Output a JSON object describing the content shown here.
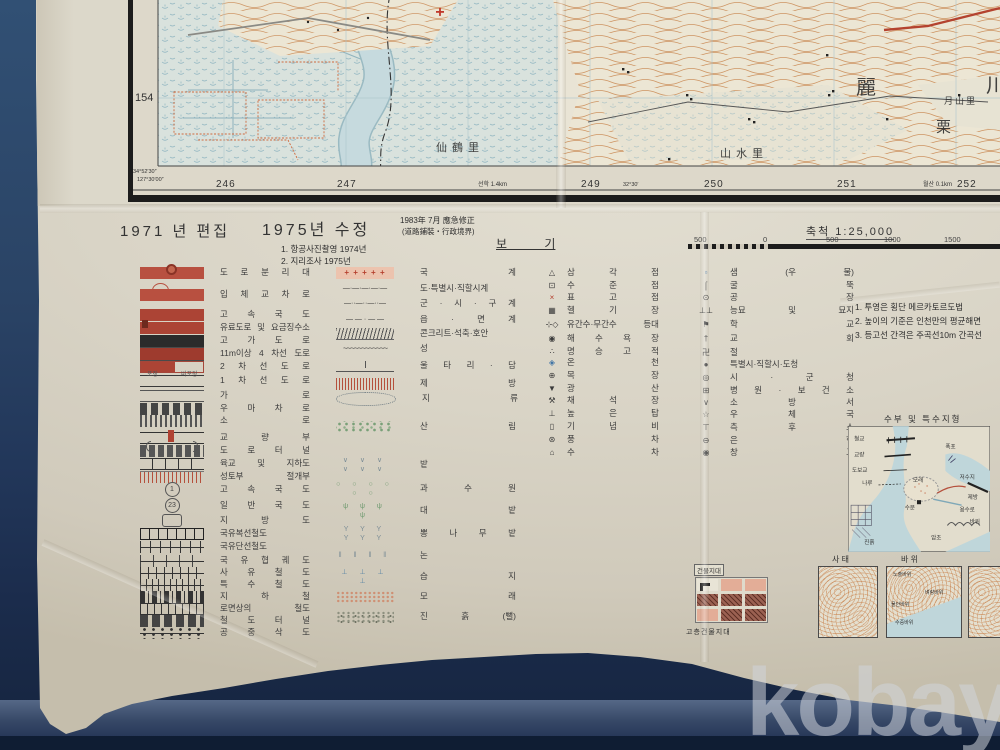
{
  "photo": {
    "watermark": "kobay"
  },
  "map": {
    "row_label": "154",
    "corner_lat": "34°52′30″",
    "corner_lon": "127°30′00″",
    "grid_numb ers_note": "easting grid labels",
    "grid_numbers": [
      "246",
      "247",
      "249",
      "250",
      "251",
      "252"
    ],
    "lon_tick": "32°30′",
    "note_left": "선학 1.4km",
    "note_right": "월산 0.1km",
    "names": {
      "n1": "仙鶴里",
      "n2": "山水里",
      "n3": "月山里",
      "c1": "麗",
      "c2": "栗",
      "c3": "川"
    }
  },
  "header": {
    "edition": "1971 년 편집",
    "revision": "1975년 수정",
    "emergency1": "1983年 7月 應急修正",
    "emergency2": "(道路鋪裝・行政境界)",
    "survey1": "1. 항공사진촬영  1974년",
    "survey2": "2. 지리조사  1975년",
    "legend_title": "보 기",
    "scale_label": "축척 1:25,000",
    "scale_ticks": [
      "500",
      "0",
      "500",
      "1000",
      "1500"
    ]
  },
  "legend": {
    "road_sub": {
      "paved": "포장",
      "unpaved": "비포장"
    },
    "roads": [
      {
        "c": "s-median",
        "g": "",
        "label": "도 로 분 리 대"
      },
      {
        "c": "s-interchange",
        "g": "",
        "label": "입 체 교 차 로"
      },
      {
        "c": "s-expwy",
        "g": "",
        "label": "고 속 국 도"
      },
      {
        "c": "s-toll",
        "g": "",
        "label": "유료도로 및 요금징수소"
      },
      {
        "c": "s-elevated",
        "g": "",
        "label": "고 가 도 로"
      },
      {
        "c": "s-lane4",
        "g": "",
        "label": "11m이상 4 차선 도로"
      },
      {
        "c": "s-lane2",
        "g": "",
        "label": "2 차 선 도 로"
      },
      {
        "c": "s-lane1",
        "g": "",
        "label": "1 차 선 도 로"
      },
      {
        "c": "s-street",
        "g": "",
        "label": "가 로"
      },
      {
        "c": "s-cart",
        "g": "",
        "label": "우 마 차 로"
      },
      {
        "c": "s-path",
        "g": "",
        "label": "소 로"
      },
      {
        "c": "s-bridge",
        "g": "",
        "label": "교 량 부"
      },
      {
        "c": "s-tunnel",
        "g": "",
        "label": "도 로 터 널"
      },
      {
        "c": "s-overpass",
        "g": "",
        "label": "육교 및 지하도"
      },
      {
        "c": "s-cutfill",
        "g": "",
        "label": "성토부 절개부"
      },
      {
        "c": "s-route-circle",
        "g": "1",
        "label": "고 속 국 도"
      },
      {
        "c": "s-route-circle",
        "g": "23",
        "label": "일 반 국 도"
      },
      {
        "c": "s-route-box",
        "g": "",
        "label": "지 방 도"
      },
      {
        "c": "s-rail2",
        "g": "",
        "label": "국유복선철도"
      },
      {
        "c": "s-rail1",
        "g": "",
        "label": "국유단선철도"
      },
      {
        "c": "s-railnarrow",
        "g": "",
        "label": "국 유 협 궤 도"
      },
      {
        "c": "s-railpriv",
        "g": "",
        "label": "사 유 철 도"
      },
      {
        "c": "s-railspec",
        "g": "",
        "label": "특 수 철 도"
      },
      {
        "c": "s-subway",
        "g": "",
        "label": "지 하 철"
      },
      {
        "c": "s-railroad",
        "g": "",
        "label": "로면상의 철도"
      },
      {
        "c": "s-railtunnel",
        "g": "",
        "label": "철 도 터 널"
      },
      {
        "c": "s-cableway",
        "g": "",
        "label": "공 중 삭 도"
      }
    ],
    "boundaries": [
      {
        "c": "b-nat",
        "g": "+ + + + +",
        "label": "국 계"
      },
      {
        "c": "b-dash1",
        "g": "—·—·—·—·—",
        "label": "도·특별시·직할시계"
      },
      {
        "c": "b-dash2",
        "g": "—··—··—··—",
        "label": "군 · 시 · 구 계"
      },
      {
        "c": "b-dash3",
        "g": "— — · — —",
        "label": "읍 · 면 계"
      },
      {
        "c": "b-hatch",
        "g": "",
        "label": "콘크리트·석축·호안"
      },
      {
        "c": "b-wave",
        "g": "~~~~~~~~~~~~",
        "label": "성"
      },
      {
        "c": "b-fence",
        "g": "",
        "label": "울 타 리 · 담"
      },
      {
        "c": "b-embank",
        "g": "",
        "label": "제 방"
      }
    ],
    "areas": [
      {
        "c": "a-landtype",
        "g": "",
        "label": "지 류"
      },
      {
        "c": "a-forest",
        "g": "",
        "label": "산 림"
      },
      {
        "c": "a-dry",
        "g": "∨ ∨ ∨ ∨ ∨ ∨",
        "label": "밭"
      },
      {
        "c": "a-orchard",
        "g": "○ ○ ○ ○ ○ ○",
        "label": "과 수 원"
      },
      {
        "c": "a-bamboo",
        "g": "ψ ψ ψ ψ",
        "label": "대 밭"
      },
      {
        "c": "a-mulberry",
        "g": "Y Y Y Y Y Y",
        "label": "뽕 나 무 밭"
      },
      {
        "c": "a-paddy",
        "g": "‖ ‖ ‖ ‖",
        "label": "논"
      },
      {
        "c": "a-marsh",
        "g": "⊥ ⊥ ⊥ ⊥",
        "label": "습 지"
      },
      {
        "c": "a-sand",
        "g": "",
        "label": "모 래"
      },
      {
        "c": "a-mud",
        "g": "",
        "label": "진 흙 (뻘)"
      }
    ],
    "points_a": [
      {
        "c": "pk",
        "g": "△",
        "label": "삼 각 점"
      },
      {
        "c": "pk",
        "g": "⊡",
        "label": "수 준 점"
      },
      {
        "c": "pr",
        "g": "×",
        "label": "표 고 점"
      },
      {
        "c": "pk",
        "g": "▦",
        "label": "헬 기 장"
      },
      {
        "c": "pk",
        "g": "⊹◇",
        "label": "유간수·무간수 등대"
      },
      {
        "c": "pk",
        "g": "◉",
        "label": "해 수 욕 장"
      },
      {
        "c": "pk",
        "g": "∴",
        "label": "명 승 고 적"
      },
      {
        "c": "pb",
        "g": "◈",
        "label": "온 천"
      },
      {
        "c": "pk",
        "g": "⊕",
        "label": "목 장"
      },
      {
        "c": "pk",
        "g": "▼",
        "label": "광 산"
      },
      {
        "c": "pk",
        "g": "⚒",
        "label": "채 석 장"
      },
      {
        "c": "pk",
        "g": "⊥",
        "label": "높 은 탑"
      },
      {
        "c": "pk",
        "g": "▯",
        "label": "기 념 비"
      },
      {
        "c": "pk",
        "g": "⊛",
        "label": "풍 차"
      },
      {
        "c": "pk",
        "g": "⌂",
        "label": "수 차"
      }
    ],
    "points_b": [
      {
        "c": "pb",
        "g": "▫",
        "label": "샘 (우 물)"
      },
      {
        "c": "pk",
        "g": "⌠",
        "label": "굴 뚝"
      },
      {
        "c": "pk",
        "g": "⊙",
        "label": "공 장"
      },
      {
        "c": "pk",
        "g": "⊥⊥",
        "label": "능묘 및 묘지"
      },
      {
        "c": "pk",
        "g": "⚑",
        "label": "학 교"
      },
      {
        "c": "pk",
        "g": "†",
        "label": "교 회"
      },
      {
        "c": "pk",
        "g": "卍",
        "label": "절"
      },
      {
        "c": "pk",
        "g": "●",
        "label": "특별시·직할시·도청"
      },
      {
        "c": "pk",
        "g": "◎",
        "label": "시 · 군 청"
      },
      {
        "c": "pk",
        "g": "⊞",
        "label": "병 원 · 보 건 소"
      },
      {
        "c": "pk",
        "g": "∨",
        "label": "소 방 서"
      },
      {
        "c": "pk",
        "g": "☆",
        "label": "우 체 국"
      },
      {
        "c": "pk",
        "g": "⊤",
        "label": "측 후 소"
      },
      {
        "c": "pk",
        "g": "⊖",
        "label": "은 행"
      },
      {
        "c": "pk",
        "g": "◉",
        "label": "창 고"
      }
    ]
  },
  "notes": {
    "l1": "1. 투영은 횡단 메르카토르도법",
    "l2": "2. 높이의 기준은 인천만의 평균해면",
    "l3": "3. 등고선 간격은 주곡선10m 간곡선"
  },
  "hydro": {
    "title": "수부 및 특수지형",
    "labels": [
      "철교",
      "교량",
      "도보교",
      "나루",
      "폭포",
      "저수지",
      "모래",
      "제방",
      "용수로",
      "수문",
      "진흙",
      "바위",
      "암초"
    ]
  },
  "minimaps": {
    "label1": "사 태",
    "label2": "바 위",
    "rocks": [
      "노출바위",
      "벼랑바위",
      "물안바위",
      "수중바위"
    ]
  },
  "buildings": {
    "top": "건물지대",
    "bottom": "고층건물지대"
  }
}
